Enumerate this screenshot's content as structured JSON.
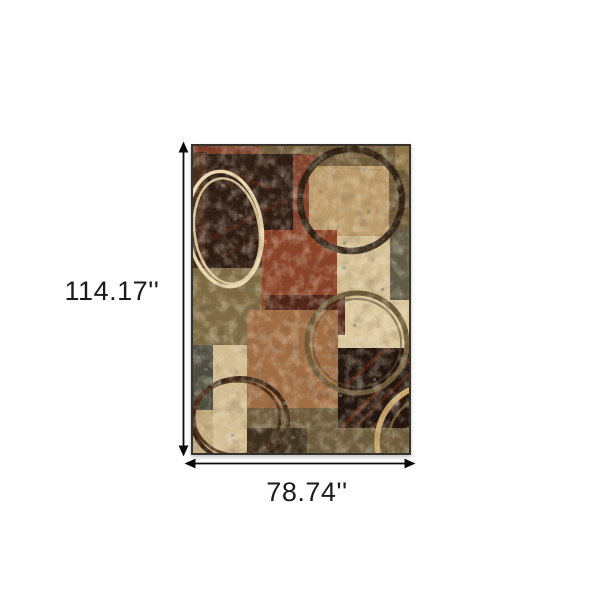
{
  "page": {
    "background": "#ffffff"
  },
  "dimensions": {
    "height_label": "114.17''",
    "width_label": "78.74''"
  },
  "rug": {
    "alt": "Brown black and beige abstract patchwork area rug with painted circle rings",
    "palette": {
      "base_olive": "#6e5a39",
      "dark_maroon": "#2c1a11",
      "rust_red": "#8a4126",
      "terracotta": "#a06c42",
      "tan": "#bd9c6b",
      "cream": "#d9c69c",
      "dark_brown": "#20120b",
      "ring_cream": "#ecd9ae",
      "ring_dark": "#281a0d",
      "ring_olive": "#6a5936",
      "border": "#35332c"
    }
  },
  "annotation": {
    "arrow_color": "#0a0a0a",
    "label_color": "#1b1b1b"
  }
}
